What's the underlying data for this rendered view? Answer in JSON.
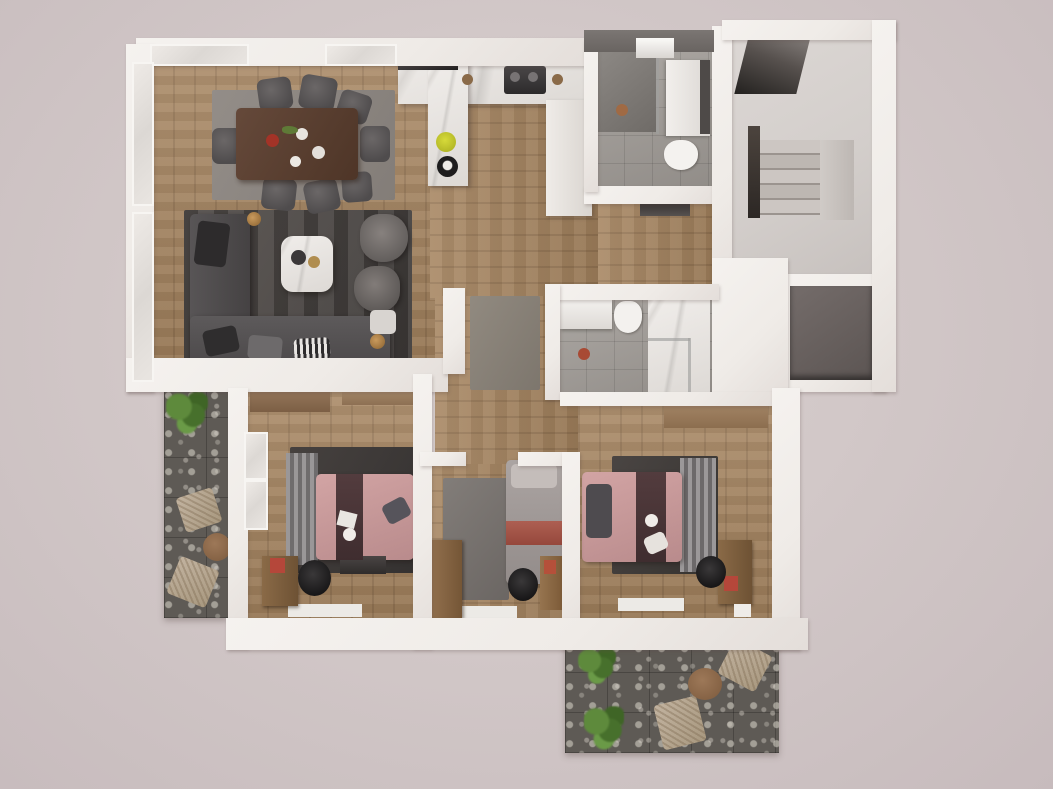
{
  "scene": {
    "kind": "3d-rendered-floor-plan",
    "view": "top-down dollhouse cutaway",
    "description": "Photorealistic top-down 3D render of a three-bedroom apartment floor plan with balcony, terrace, staircase and two bathrooms",
    "text_visible": "none"
  },
  "palette": {
    "background": "#cdc2c3",
    "walls": "#f2efeb",
    "wall_dark": "#6f6a67",
    "wood_floor": "#a5845f",
    "dark_area_rug": "#4a4543",
    "gray_rug": "#8d8782",
    "sofa_gray": "#504d4e",
    "bathroom_tile": "#a19c97",
    "concrete": "#d5d0cd",
    "stone_tile": "#5e5a55",
    "bed_pink": "#c79899",
    "bed_runner_dark": "#4a3537",
    "accent_red": "#b5473a",
    "plant_green": "#5e8a3c",
    "wicker_tan": "#b5a693",
    "table_walnut": "#5a4130",
    "kettle_yellow": "#c8cc2e"
  },
  "rooms": [
    {
      "name": "Living and dining room",
      "furniture": [
        "dining table",
        "eight dining chairs",
        "dining rug",
        "L-shaped sectional sofa",
        "throw pillows",
        "marble coffee table",
        "two armchairs",
        "dark area rug",
        "floor lamp",
        "side table"
      ]
    },
    {
      "name": "Kitchen",
      "furniture": [
        "U-shaped white counter",
        "cooktop with hob",
        "dark built-in appliance",
        "peninsula counter",
        "yellow kettle",
        "coffee maker",
        "tall cabinet column"
      ]
    },
    {
      "name": "Bathroom upper",
      "furniture": [
        "walk-in shower",
        "skylight",
        "white vanity",
        "toilet"
      ]
    },
    {
      "name": "Staircase",
      "furniture": [
        "upper flight",
        "stair treads",
        "landing"
      ]
    },
    {
      "name": "Elevator shaft",
      "furniture": [
        "dark elevator cab"
      ]
    },
    {
      "name": "Entry hall",
      "furniture": [
        "wood floor",
        "gray runner rug",
        "entry threshold"
      ]
    },
    {
      "name": "Bathroom lower",
      "furniture": [
        "white vanity",
        "toilet",
        "marble shower enclosure"
      ]
    },
    {
      "name": "Bedroom left",
      "furniture": [
        "double bed with pink duvet",
        "dark bed runner",
        "gray headboard throw",
        "dark area rug",
        "two wardrobes",
        "wooden desk with red poster",
        "black office chair",
        "low dark dresser",
        "white floor mat",
        "window panels"
      ]
    },
    {
      "name": "Middle bedroom",
      "furniture": [
        "single bed with gray duvet and red stripe",
        "gray rug",
        "wooden wardrobe",
        "desk chair",
        "bookshelf with red poster",
        "white floor mat"
      ]
    },
    {
      "name": "Bedroom right",
      "furniture": [
        "double bed with pink duvet",
        "dark bed runner",
        "dark pillow",
        "striped gray rug",
        "wooden wardrobe",
        "wooden desk with red poster",
        "black office chair",
        "white floor mats"
      ]
    },
    {
      "name": "Balcony",
      "furniture": [
        "green plant",
        "two wicker chairs",
        "round wooden table",
        "dark stone tiles"
      ]
    },
    {
      "name": "Terrace",
      "furniture": [
        "two green plants",
        "two wicker lounge chairs",
        "round wooden table",
        "dark stone tiles"
      ]
    }
  ]
}
